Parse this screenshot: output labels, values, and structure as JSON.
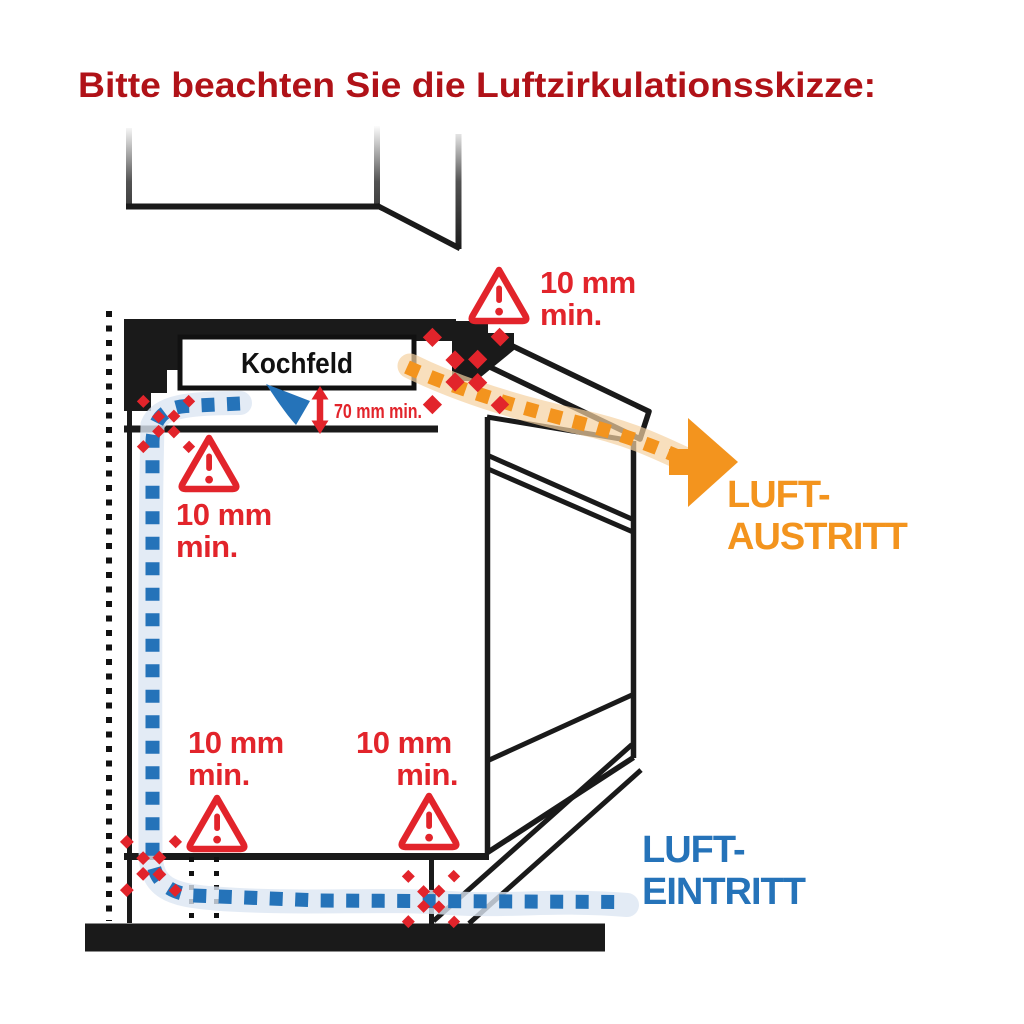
{
  "title": "Bitte beachten Sie die Luftzirkulationsskizze:",
  "diagram": {
    "cooktop_label": "Kochfeld",
    "height_clearance_label": "70 mm min.",
    "gap_clearance": {
      "line1": "10 mm",
      "line2": "min."
    },
    "air_outlet": {
      "line1": "LUFT-",
      "line2": "AUSTRITT"
    },
    "air_inlet": {
      "line1": "LUFT-",
      "line2": "EINTRITT"
    },
    "warning_icon_glyph": "!"
  },
  "colors": {
    "title_red": "#B01218",
    "warning_red": "#E2242B",
    "inlet_blue": "#2573B9",
    "inlet_ribbon_blue": "#DCE6F2",
    "outlet_orange": "#F3941E",
    "outlet_ribbon_orange": "#F5D2A1",
    "line_black": "#1A1A1A"
  }
}
